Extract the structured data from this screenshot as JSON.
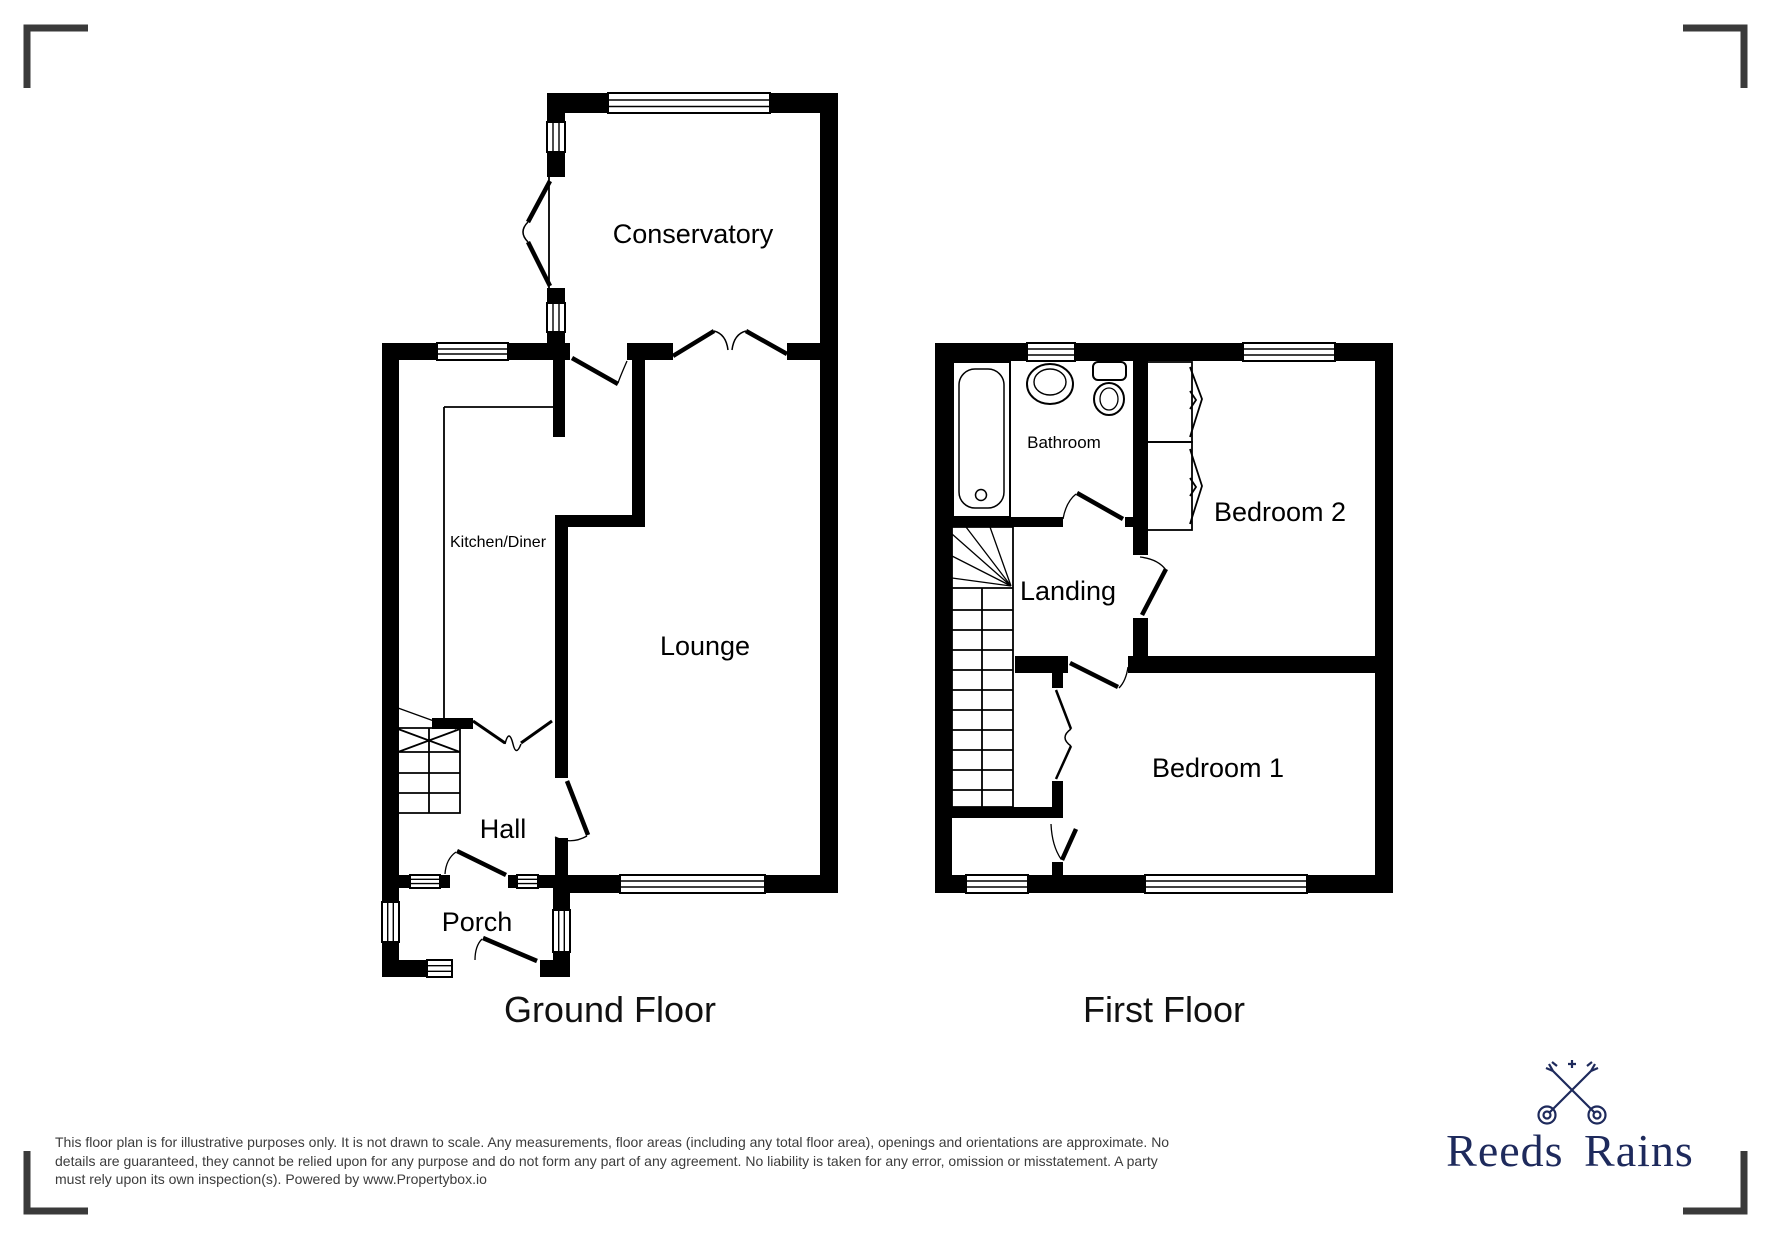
{
  "plan": {
    "floors": [
      {
        "title": "Ground Floor",
        "rooms": [
          {
            "label": "Conservatory"
          },
          {
            "label": "Kitchen/Diner"
          },
          {
            "label": "Lounge"
          },
          {
            "label": "Hall"
          },
          {
            "label": "Porch"
          }
        ]
      },
      {
        "title": "First Floor",
        "rooms": [
          {
            "label": "Bathroom"
          },
          {
            "label": "Bedroom 2"
          },
          {
            "label": "Landing"
          },
          {
            "label": "Bedroom 1"
          }
        ]
      }
    ],
    "icons": {
      "stairs": "stairs-icon",
      "bath": "bath-icon",
      "sink": "sink-icon",
      "toilet": "toilet-icon",
      "wardrobe": "wardrobe-icon",
      "window": "window-icon",
      "door": "door-icon",
      "crop_mark": "crop-mark-icon"
    },
    "colors": {
      "wall": "#000000",
      "crop_mark": "#3a3a3a"
    }
  },
  "footer": {
    "disclaimer_lines": [
      "This floor plan is for illustrative purposes only. It is not drawn to scale. Any measurements, floor areas (including any total floor area), openings and orientations are approximate. No",
      "details are guaranteed, they cannot be relied upon for any purpose and do not form any part of any agreement. No liability is taken for any error, omission or misstatement. A party",
      "must rely upon its own inspection(s). Powered by www.Propertybox.io"
    ],
    "text_color": "#3c3c3c"
  },
  "logo": {
    "brand": "Reeds Rains",
    "icon": "crossed-keys-icon",
    "color": "#1e2a5c"
  }
}
